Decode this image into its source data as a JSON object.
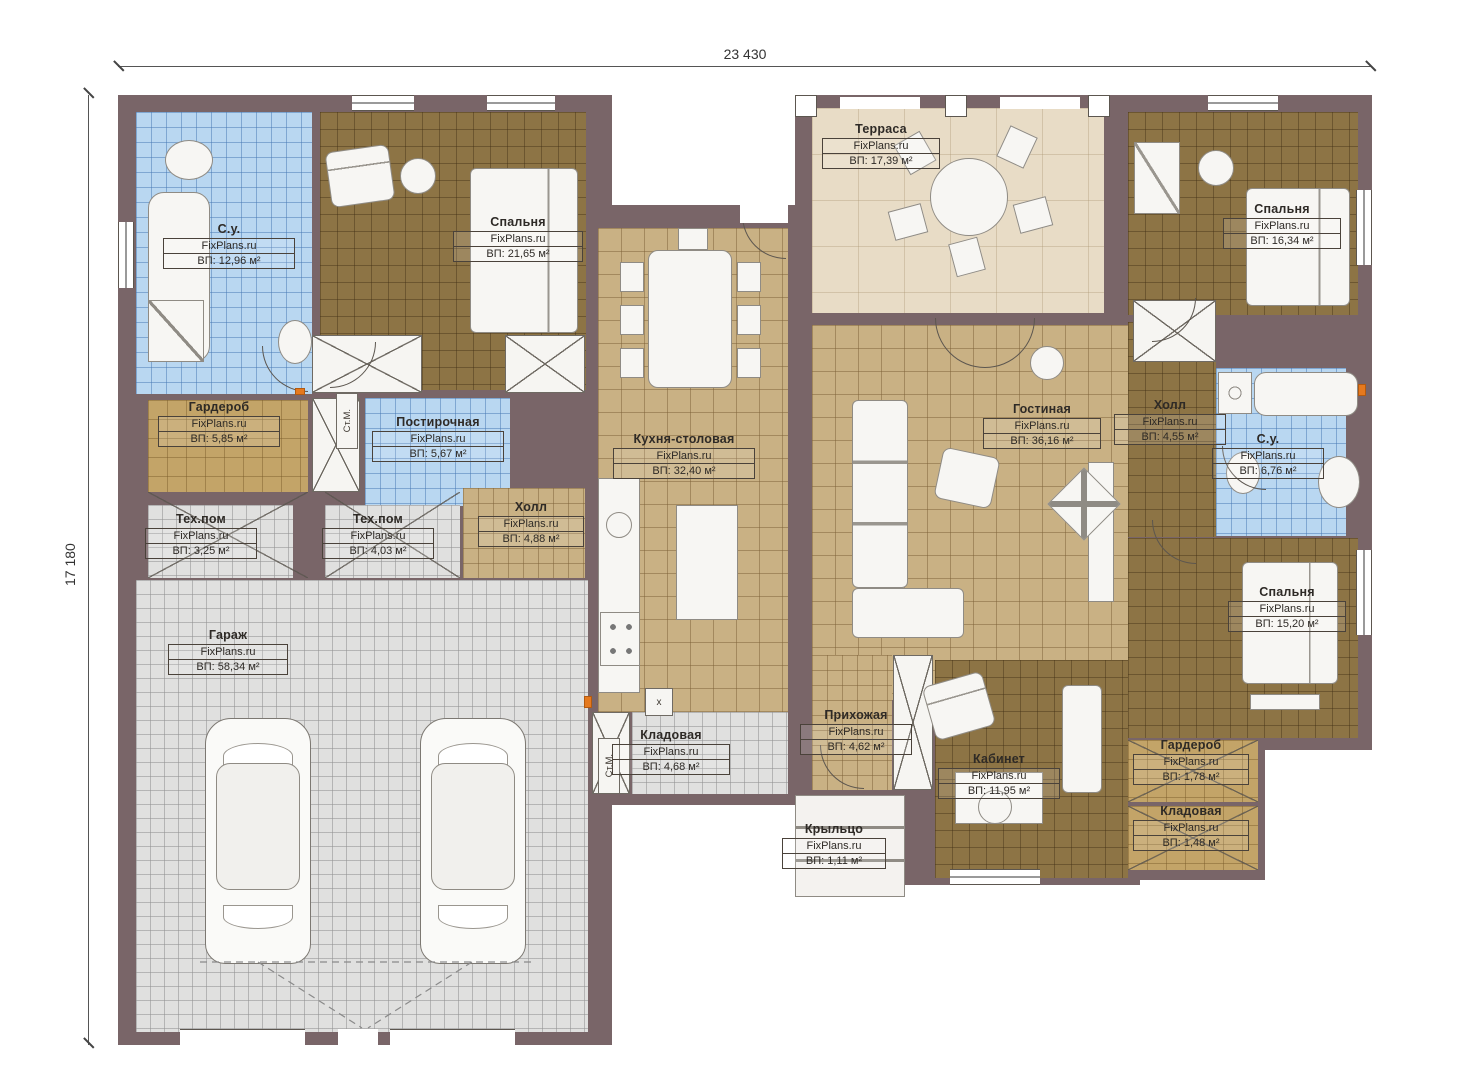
{
  "brand": "FixPlans.ru",
  "dimensions": {
    "top": "23 430",
    "left": "17 180"
  },
  "annotations": {
    "washer": "Ст.М.",
    "boiler": "х"
  },
  "rooms": [
    {
      "id": "su1",
      "name": "С.у.",
      "area": "ВП: 12,96 м²"
    },
    {
      "id": "bedroom1",
      "name": "Спальня",
      "area": "ВП: 21,65 м²"
    },
    {
      "id": "wardrobe1",
      "name": "Гардероб",
      "area": "ВП: 5,85 м²"
    },
    {
      "id": "laundry",
      "name": "Постирочная",
      "area": "ВП: 5,67 м²"
    },
    {
      "id": "tech1",
      "name": "Тех.пом",
      "area": "ВП: 3,25 м²"
    },
    {
      "id": "tech2",
      "name": "Тех.пом",
      "area": "ВП: 4,03 м²"
    },
    {
      "id": "hall1",
      "name": "Холл",
      "area": "ВП: 4,88 м²"
    },
    {
      "id": "garage",
      "name": "Гараж",
      "area": "ВП: 58,34 м²"
    },
    {
      "id": "kitchen",
      "name": "Кухня-столовая",
      "area": "ВП: 32,40 м²"
    },
    {
      "id": "pantry1",
      "name": "Кладовая",
      "area": "ВП: 4,68 м²"
    },
    {
      "id": "terrace",
      "name": "Терраса",
      "area": "ВП: 17,39 м²"
    },
    {
      "id": "living",
      "name": "Гостиная",
      "area": "ВП: 36,16 м²"
    },
    {
      "id": "entry",
      "name": "Прихожая",
      "area": "ВП: 4,62 м²"
    },
    {
      "id": "office",
      "name": "Кабинет",
      "area": "ВП: 11,95 м²"
    },
    {
      "id": "hall2",
      "name": "Холл",
      "area": "ВП: 4,55 м²"
    },
    {
      "id": "su2",
      "name": "С.у.",
      "area": "ВП: 6,76 м²"
    },
    {
      "id": "bedroom2",
      "name": "Спальня",
      "area": "ВП: 16,34 м²"
    },
    {
      "id": "bedroom3",
      "name": "Спальня",
      "area": "ВП: 15,20 м²"
    },
    {
      "id": "wardrobe2",
      "name": "Гардероб",
      "area": "ВП: 1,78 м²"
    },
    {
      "id": "pantry2",
      "name": "Кладовая",
      "area": "ВП: 1,48 м²"
    },
    {
      "id": "porch",
      "name": "Крыльцо",
      "area": "ВП: 1,11 м²"
    }
  ]
}
